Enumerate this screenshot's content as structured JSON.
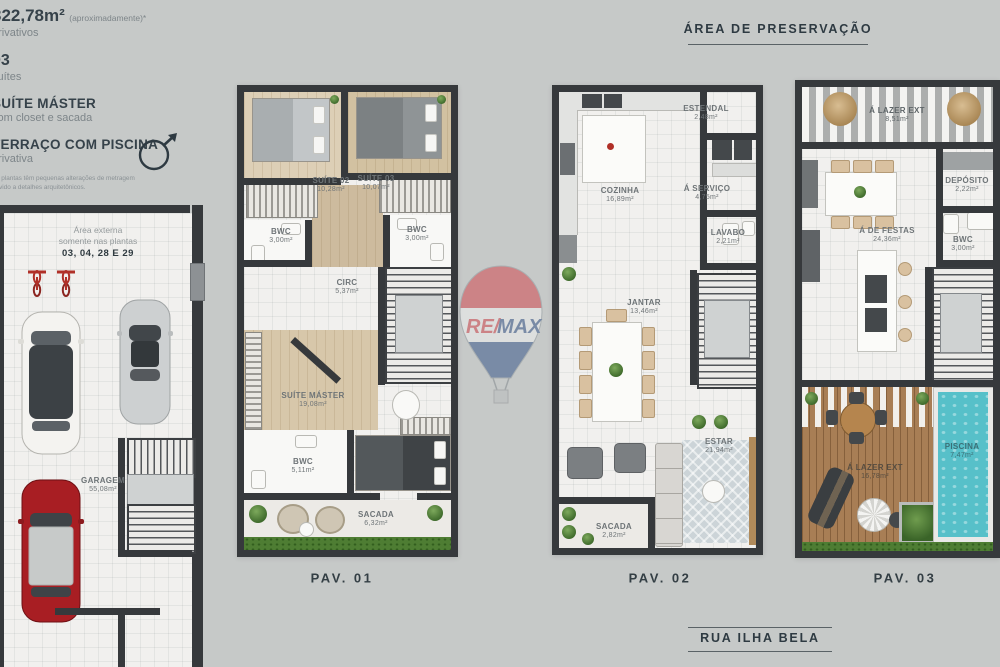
{
  "colors": {
    "background": "#c6c9c8",
    "wall": "#36393c",
    "floor": "#f1f0ee",
    "wood": "#d7c7aa",
    "grass": "#4e7d33",
    "deck": "#a87e55",
    "pool": "#57c0c9",
    "remax_red": "#d23f47",
    "remax_blue": "#2f4f86",
    "label_gray": "#6e7477",
    "title_dark": "#333e44"
  },
  "info_panel": {
    "area_value": "322,78m²",
    "area_note": "(aproximadamente)*",
    "area_caption": "privativos",
    "suites_value": "03",
    "suites_caption": "suítes",
    "feature1_title": "SUÍTE MÁSTER",
    "feature1_caption": "com closet e sacada",
    "feature2_title": "TERRAÇO COM PISCINA",
    "feature2_caption": "privativa",
    "disclaimer": "As plantas têm pequenas alterações de metragem devido a detalhes arquitetônicos."
  },
  "headers": {
    "preservation_area": "ÁREA DE PRESERVAÇÃO",
    "street": "RUA ILHA BELA"
  },
  "watermark": {
    "brand_left": "RE/",
    "brand_right": "MAX"
  },
  "garage": {
    "note_line1": "Área externa",
    "note_line2": "somente nas plantas",
    "note_line3": "03, 04, 28 E 29",
    "room_name": "GARAGEM",
    "room_area": "55,08m²"
  },
  "pav1": {
    "label": "PAV. 01",
    "suite02": {
      "name": "SUÍTE 02",
      "area": "10,28m²"
    },
    "suite03": {
      "name": "SUÍTE 03",
      "area": "10,07m²"
    },
    "bwc_left": {
      "name": "BWC",
      "area": "3,00m²"
    },
    "bwc_right": {
      "name": "BWC",
      "area": "3,00m²"
    },
    "circ": {
      "name": "CIRC",
      "area": "5,37m²"
    },
    "suite_master": {
      "name": "SUÍTE MÁSTER",
      "area": "19,08m²"
    },
    "bwc_master": {
      "name": "BWC",
      "area": "5,11m²"
    },
    "sacada": {
      "name": "SACADA",
      "area": "6,32m²"
    }
  },
  "pav2": {
    "label": "PAV. 02",
    "estendal": {
      "name": "ESTENDAL",
      "area": "2,48m²"
    },
    "cozinha": {
      "name": "COZINHA",
      "area": "16,89m²"
    },
    "servico": {
      "name": "Á SERVIÇO",
      "area": "4,75m²"
    },
    "lavabo": {
      "name": "LAVABO",
      "area": "2,21m²"
    },
    "jantar": {
      "name": "JANTAR",
      "area": "13,46m²"
    },
    "estar": {
      "name": "ESTAR",
      "area": "21,94m²"
    },
    "sacada": {
      "name": "SACADA",
      "area": "2,82m²"
    }
  },
  "pav3": {
    "label": "PAV. 03",
    "lazer_top": {
      "name": "Á LAZER EXT",
      "area": "8,51m²"
    },
    "deposito": {
      "name": "DEPÓSITO",
      "area": "2,22m²"
    },
    "festas": {
      "name": "Á DE FESTAS",
      "area": "24,36m²"
    },
    "bwc": {
      "name": "BWC",
      "area": "3,00m²"
    },
    "lazer_deck": {
      "name": "Á LAZER EXT",
      "area": "16,78m²"
    },
    "piscina": {
      "name": "PISCINA",
      "area": "7,47m²"
    }
  }
}
